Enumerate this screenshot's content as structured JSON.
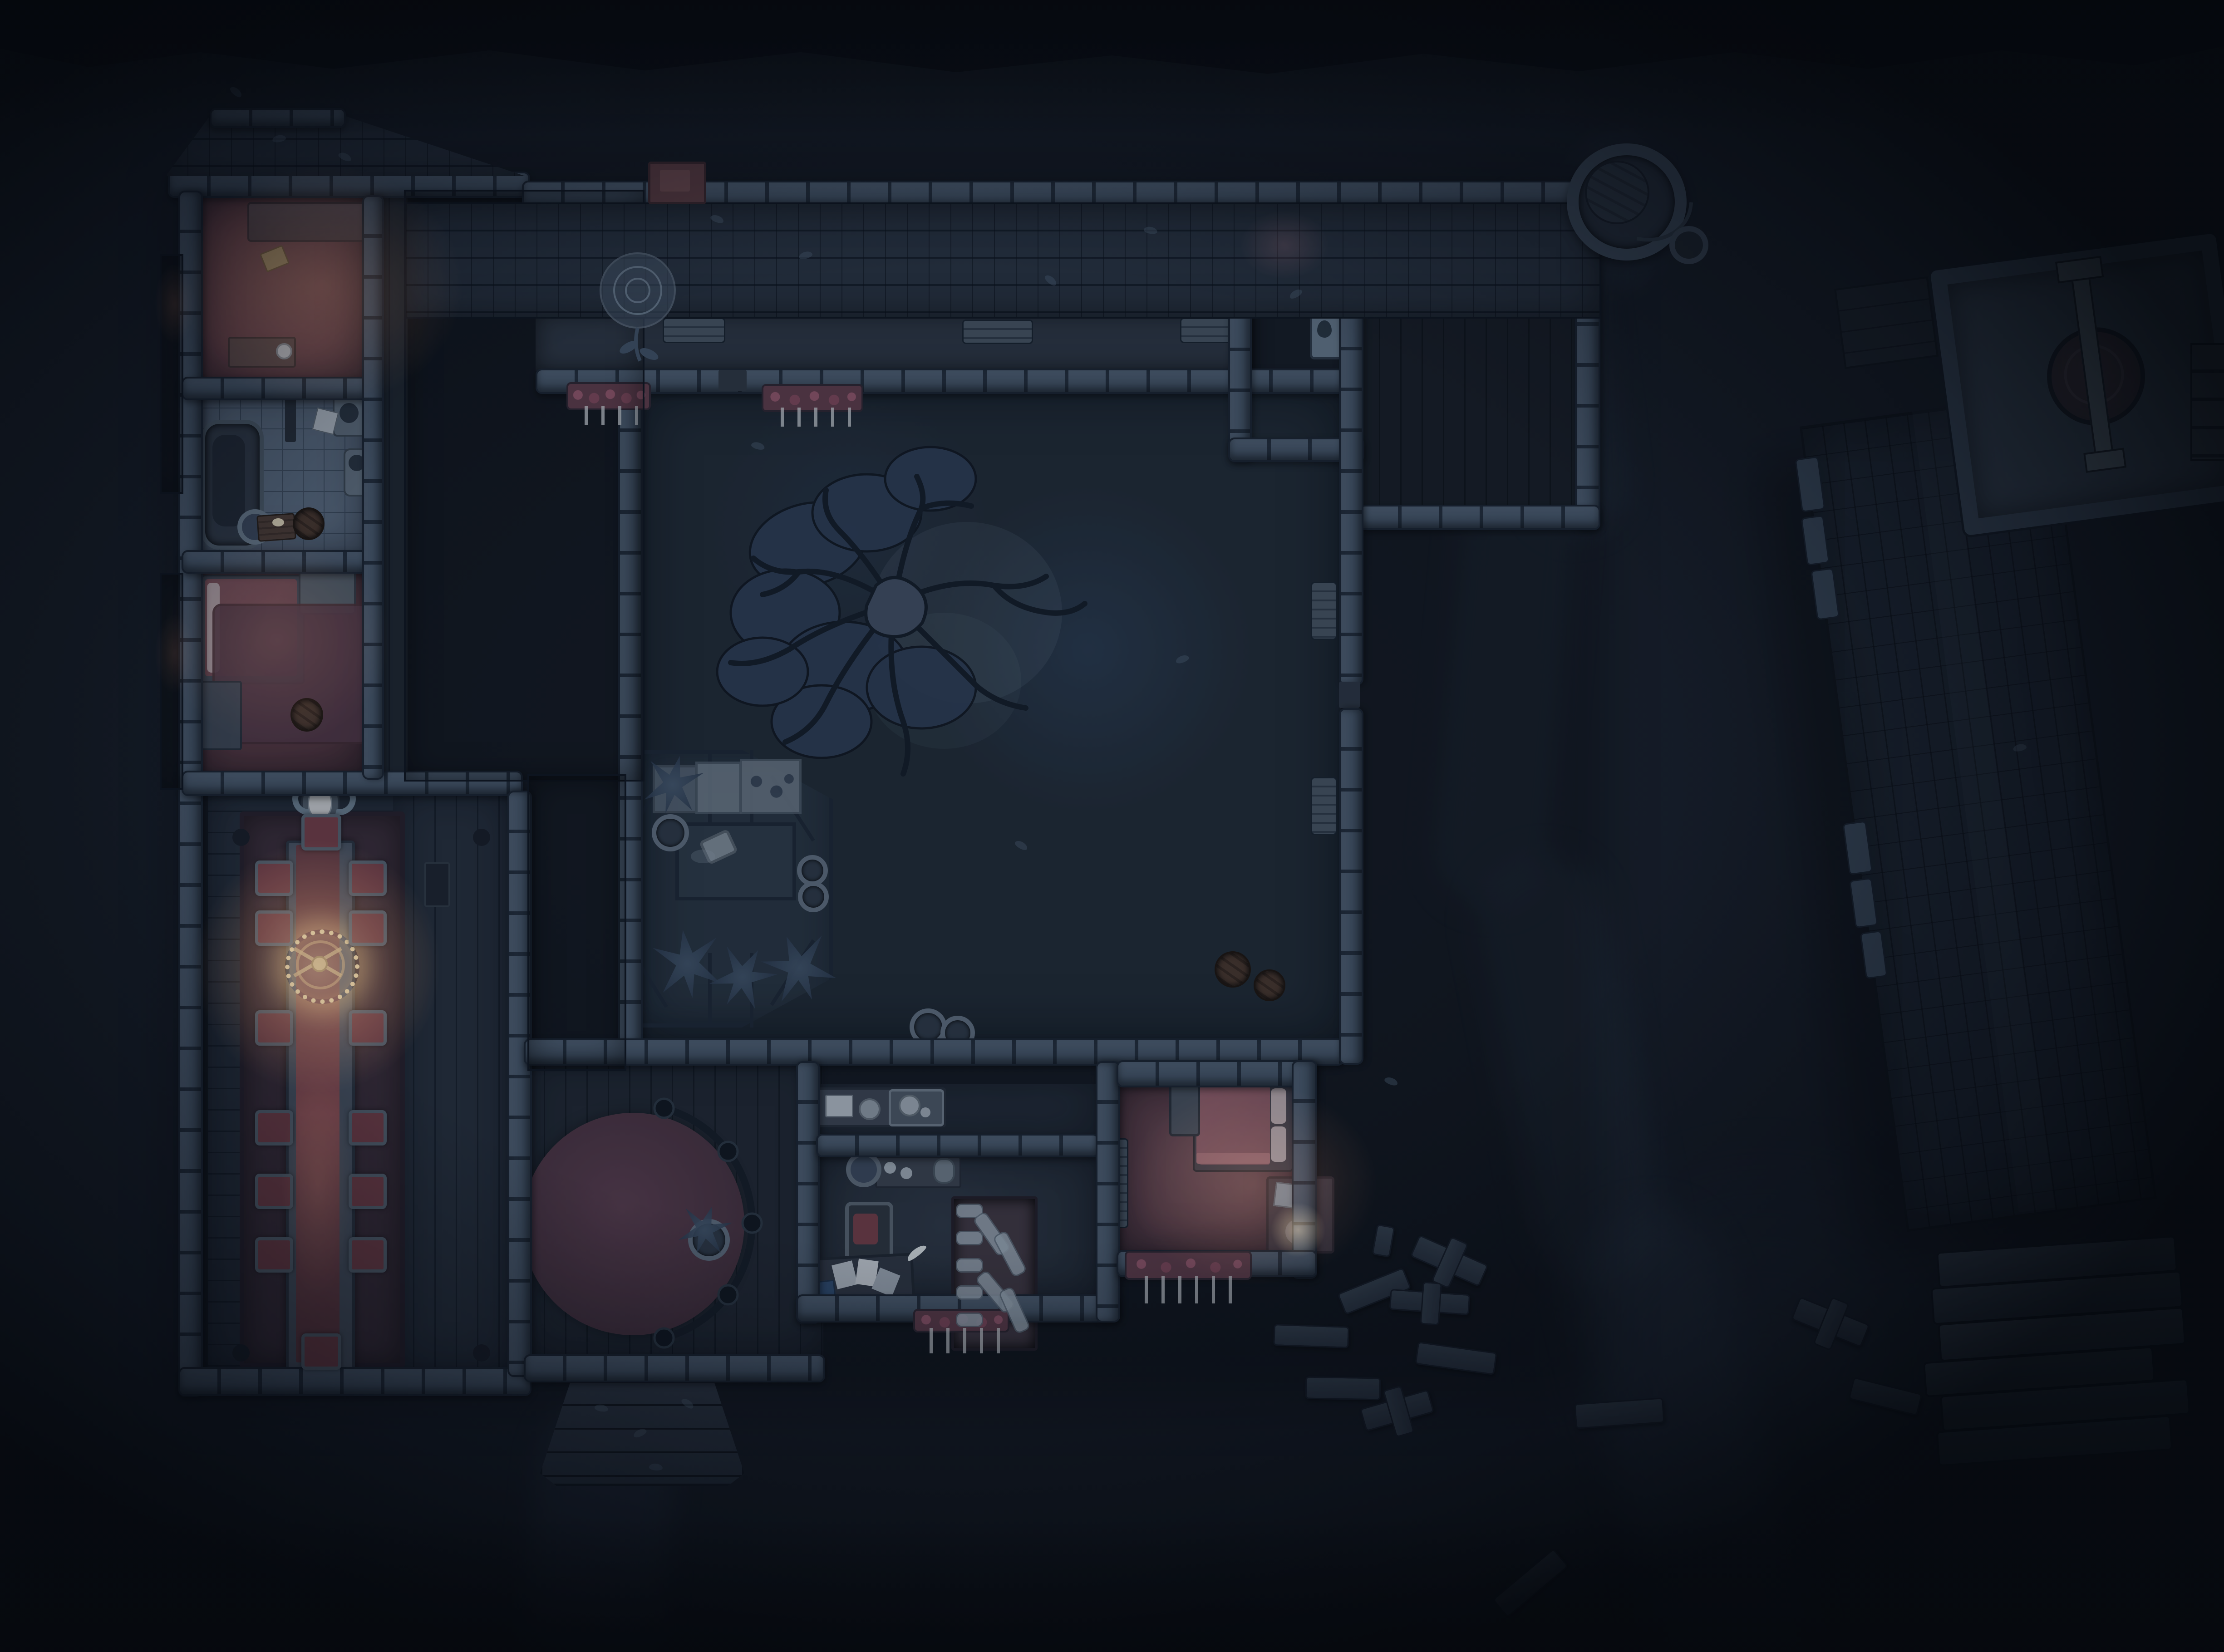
{
  "scene": {
    "kind": "top-down night battlemap of a manor estate",
    "grid_visible": false,
    "lit_areas": [
      "north bedroom",
      "middle bedroom",
      "dining hall chandelier",
      "master bedroom",
      "nightstand candle",
      "chapel candles"
    ]
  },
  "palette": {
    "ground": "#151b25",
    "groundLight": "#1c2431",
    "treeline": "#0a0e15",
    "path": "#25303f",
    "grass": "#1f2934",
    "stoneLight": "#4d5d70",
    "stoneMid": "#3a495b",
    "stoneJoint": "#202b39",
    "roofN": "#27313f",
    "roofW": "#1f2order834",
    "roofWfix": "#1f2834",
    "roofLine": "#141c28",
    "millRoof": "#1d2632",
    "millLine": "#11171f",
    "plank": "#242d3a",
    "plankLine": "#161e29",
    "tile": "#57677b",
    "tileLine": "#3b4a5c",
    "roomRed": "#6e434b",
    "roomRedDim": "#523640",
    "diningFloor": "#232b38",
    "carpet": "#372b37",
    "carpetBorder": "#241e2a",
    "runner": "#6f4049",
    "cushion": "#6f3c46",
    "chairFrame": "#525f6d",
    "tableFrame": "#46505f",
    "rug": "#4d3544",
    "bedFrame": "#38414f",
    "mattress": "#6b444f",
    "blanket": "#855463",
    "pillow": "#b0a3a8",
    "paper": "#aeb7c0",
    "scroll": "#97a5b2",
    "bookBlue": "#2e4a6e",
    "glassFill": "rgba(120,150,185,0.09)",
    "mullion": "#1c2634",
    "bedBox": "#6f7d8b",
    "plant": "#41546a",
    "potRing": "#5d6b7b",
    "stoneFloor": "#374453",
    "millstone": "#332c34",
    "beam": "#57646f",
    "candle": "#f2d4a0",
    "tulip": "#c7ccd1",
    "flowerBase": "#5c3a48",
    "flowerDot1": "#8e5468",
    "flowerDot2": "#7c4659",
    "benchWood": "#44515f",
    "porch": "#2b3442",
    "fixture": "#5d6b7a",
    "fixtureDark": "#27313e",
    "barrel": "#46352c",
    "nightstand": "#3e3641",
    "chest": "#444d5a",
    "shrine": "#627486",
    "wellStone": "#3c4a5a",
    "wellLid": "#2b3542"
  },
  "features": [
    "night-ground",
    "tree-line",
    "dirt-paths",
    "manor-west-wing",
    "gable-roof",
    "lit-bedroom-north",
    "bathroom",
    "bathtub",
    "toilet",
    "wash-basin",
    "lit-bedroom-middle",
    "dining-hall",
    "long-dining-table",
    "candle-chandelier",
    "ram-skull-trophy",
    "dining-chairs",
    "north-wing-roof",
    "brick-chimney",
    "north-corridor",
    "window-flower-boxes",
    "chapel-nook",
    "shrine-plaque",
    "wall-bench",
    "inner-courtyard",
    "dead-tree",
    "greenhouse",
    "planting-beds",
    "potted-plants",
    "tipped-bucket",
    "round-parlor",
    "round-rug",
    "curved-railing",
    "entry-porch",
    "pantry-sideboard",
    "tea-tray",
    "study",
    "writing-desk",
    "scattered-papers",
    "armchair",
    "scroll-shelf",
    "lit-master-bedroom",
    "double-bed",
    "storage-chest",
    "nightstand-candle",
    "bedside-bench",
    "grave-markers",
    "lumber-pile",
    "stone-well",
    "well-bucket",
    "mill-barn-roof",
    "millstone-platform",
    "millstone",
    "wooden-stairs",
    "courtyard-barrels",
    "scattered-leaves",
    "rose-vine"
  ]
}
